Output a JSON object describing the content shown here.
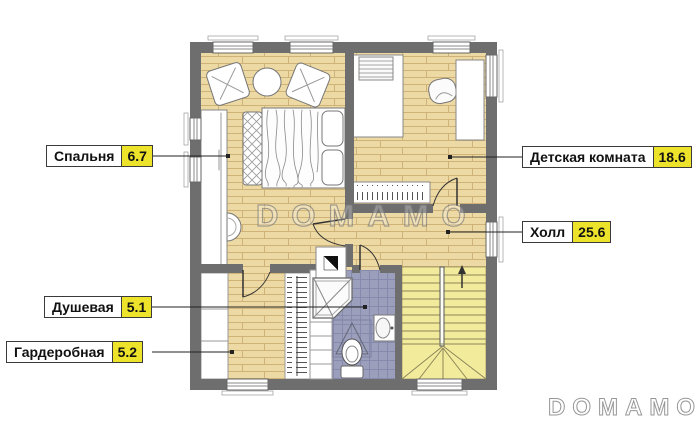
{
  "watermarks": {
    "center": "DOMAMO",
    "corner": "DOMAMO"
  },
  "rooms": {
    "bedroom": {
      "name": "Спальня",
      "area": "6.7"
    },
    "kids_room": {
      "name": "Детская комната",
      "area": "18.6"
    },
    "hall": {
      "name": "Холл",
      "area": "25.6"
    },
    "shower": {
      "name": "Душевая",
      "area": "5.1"
    },
    "wardrobe": {
      "name": "Гардеробная",
      "area": "5.2"
    }
  },
  "colors": {
    "area_badge_yellow": "#ede32b",
    "wall_gray": "#6e6e6e",
    "wood_floor": "#edd9a3",
    "tile_floor": "#9b9fbb",
    "stairs_yellow": "#f3eb9c",
    "label_border": "#3a3a3a"
  }
}
